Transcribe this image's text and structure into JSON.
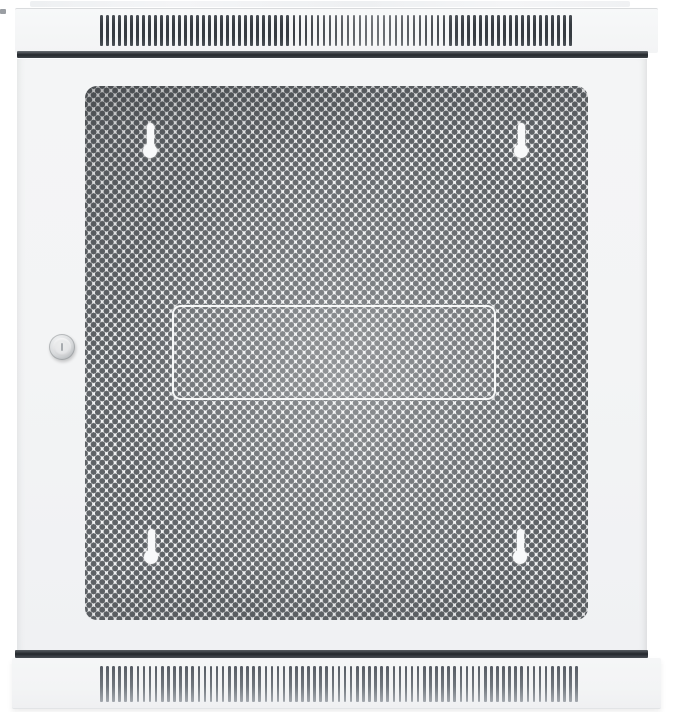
{
  "scene": {
    "subject": "White wall-mount server rack cabinet, front view, with closed perforated mesh door",
    "setting": "plain white background, no visible text or labels"
  },
  "colors": {
    "background": "#ffffff",
    "panel": "#f3f4f5",
    "panel_edge": "#d9dbdd",
    "slat_dark": "#363b41",
    "slat_bottom": "#70767d",
    "mesh_hole": "#5f6367",
    "shadow_gap": "#23272c",
    "lock_ring": "#b6b9bc",
    "lock_face": "#e4e5e7",
    "keyhole_white": "#f8f9fa"
  },
  "cabinet": {
    "top_vent": {
      "name": "top ventilation grille",
      "slat_count": 79
    },
    "bottom_vent": {
      "name": "bottom ventilation grille",
      "slat_count": 79
    },
    "door": {
      "name": "perforated mesh door",
      "mesh_pattern": "staggered round perforations",
      "keyhole_mount_count": 4,
      "lock": "round cam lock with vertical keyhole",
      "center_outline": "recessed rectangular panel outline"
    }
  }
}
